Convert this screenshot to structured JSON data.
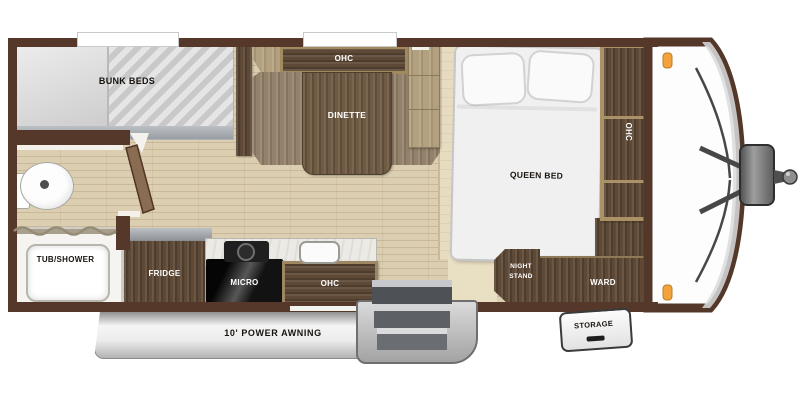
{
  "floorplan": {
    "rooms": {
      "bunk_beds": "BUNK BEDS",
      "tub_shower": "TUB/SHOWER",
      "fridge": "FRIDGE",
      "micro": "MICRO",
      "kitchen_ohc": "OHC",
      "dinette_ohc": "OHC",
      "dinette": "DINETTE",
      "queen_bed": "QUEEN BED",
      "night_stand": "NIGHT STAND",
      "ward": "WARD",
      "bedroom_ohc": "OHC",
      "storage": "STORAGE",
      "awning": "10' POWER AWNING"
    },
    "palette": {
      "wall": "#55382a",
      "floor": "#dccfb1",
      "dark_wood": "#5d4936",
      "bench_wood": "#93816a",
      "tan_wood": "#b3a07e",
      "clearance_light": "#f3a33b",
      "awning_silver": "#d9d9d9",
      "mattress": "#d9d9d9"
    }
  }
}
